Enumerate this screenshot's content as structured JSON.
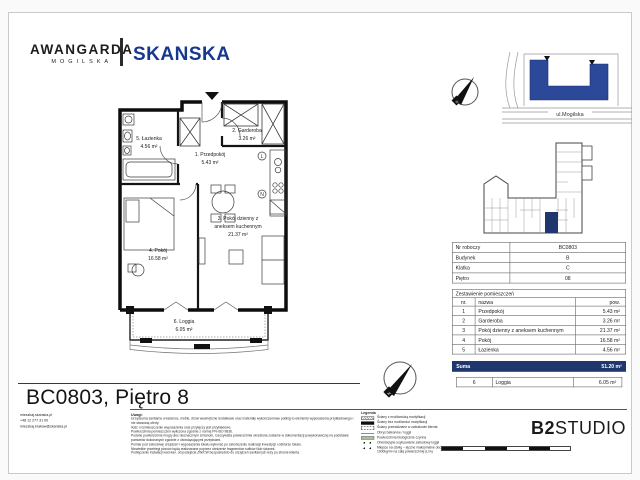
{
  "colors": {
    "skanska_blue": "#16388e",
    "navy_bar": "#20376e",
    "map_blue": "#2b4899"
  },
  "header": {
    "brand_line1": "AWANGARDA",
    "brand_line2": "MOGILSKA",
    "partner": "SKANSKA"
  },
  "plan": {
    "rooms": {
      "lazienka": {
        "label": "5. Łazienka",
        "area": "4.56 m²"
      },
      "przedpokoj": {
        "label": "1. Przedpokój",
        "area": "5.43 m²"
      },
      "garderoba": {
        "label": "2. Garderoba",
        "area": "3.26 m²"
      },
      "dzienny": {
        "label_line1": "3. Pokój dzienny z",
        "label_line2": "aneksem kuchennym",
        "area": "21.37 m²"
      },
      "pokoj": {
        "label": "4. Pokój",
        "area": "16.58 m²"
      },
      "loggia": {
        "label": "6. Loggia",
        "area": "6.05 m²"
      }
    },
    "symbols": {
      "circle_l": "L",
      "circle_n": "N",
      "compass": "N"
    }
  },
  "site_map": {
    "street_label": "ul.Mogilska"
  },
  "info_table": {
    "rows": [
      {
        "label": "Nr roboczy",
        "value": "BC0803"
      },
      {
        "label": "Budynek",
        "value": "B"
      },
      {
        "label": "Klatka",
        "value": "C"
      },
      {
        "label": "Piętro",
        "value": "08"
      }
    ]
  },
  "rooms_table": {
    "title": "Zestawienie pomieszczeń",
    "headers": {
      "nr": "nr.",
      "name": "nazwa",
      "area": "pow."
    },
    "rows": [
      {
        "nr": "1",
        "name": "Przedpokój",
        "area": "5.43 m²"
      },
      {
        "nr": "2",
        "name": "Garderoba",
        "area": "3.26 m²"
      },
      {
        "nr": "3",
        "name": "Pokój dzienny z aneksem kuchennym",
        "area": "21.37 m²"
      },
      {
        "nr": "4",
        "name": "Pokój",
        "area": "16.58 m²"
      },
      {
        "nr": "5",
        "name": "Łazienka",
        "area": "4.56 m²"
      }
    ],
    "suma_label": "Suma",
    "suma_value": "51.20 m²",
    "loggia_row": {
      "nr": "6",
      "name": "Loggia",
      "area": "6.05 m²"
    }
  },
  "footer": {
    "title": "BC0803, Piętro 8",
    "contact": [
      "mieszkaj.skanska.pl",
      "+48 12 277 31 00",
      "mieszkaj.krakow@skanska.pl"
    ],
    "uwagi_title": "Uwagi:",
    "uwagi_lines": [
      "Urządzenia sanitarne w łazience, meble, drzwi wewnętrzne dodatkowe oraz materiały wykończeniowe podłóg to elementy wyposażenia przykładowego i nie stanowią oferty.",
      "Ilość i rozmieszczenie wyposażenia oraz przyłączy jest przykładowe.",
      "Powierzchnia pomieszczeń wyliczona zgodnie z normą PN-ISO 9836.",
      "Podane powierzchnie mogą ulec nieznacznym zmianom, rzeczywista powierzchnia określona zostanie w dokumentacji powykonawczej na podstawie pomiarów dokonanych zgodnie z obowiązującymi przepisami.",
      "Pomiar pod zabudowę urządzeń i wyposażenia lokalu wykonać po zakończeniu realizacji inwestycji i odbiorze lokalu.",
      "Niewielkie przebiegi pionów będą realizowane poprzez obniżenie fragmentów sufitów i/lub ścianek.",
      "Podłączenie instalacji wod-kan. od podejścia ZW/CW bezpośrednio do urządzeń sanitarnych leży po stronie klienta."
    ],
    "legend_title": "Legenda",
    "legend_items": [
      {
        "label": "Ściany z możliwością modyfikacji"
      },
      {
        "label": "Ściany bez możliwości modyfikacji"
      },
      {
        "label": "Ściany przewidziane w zabudowie klienta"
      },
      {
        "label": "Obrys balkonów / loggii"
      },
      {
        "label": "Powierzchnia biologicznie czynna"
      },
      {
        "label": "Orientacyjne usytuowanie zabudowy loggii"
      },
      {
        "label": "Miejsce na dźwig – łączne maksymalne obciążenie do 1000kg lub 1000kg/m² na całą powierzchnię (L/m)"
      }
    ],
    "studio_bold": "B2",
    "studio_rest": "STUDIO"
  }
}
